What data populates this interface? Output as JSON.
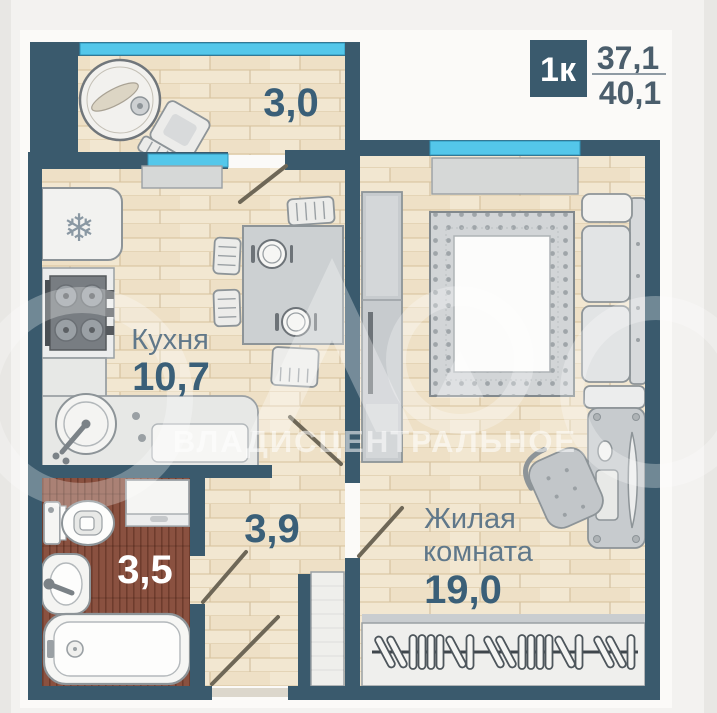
{
  "badge": {
    "rooms": "1к",
    "area_top": "37,1",
    "area_bottom": "40,1"
  },
  "rooms": {
    "balcony": {
      "area": "3,0"
    },
    "kitchen": {
      "name": "Кухня",
      "area": "10,7"
    },
    "bathroom": {
      "area": "3,5"
    },
    "hallway": {
      "area": "3,9"
    },
    "living_room": {
      "name_line1": "Жилая",
      "name_line2": "комната",
      "area": "19,0"
    }
  },
  "watermark": {
    "text": "ВЛАДИСЦЕНТРАЛЬНОЕ"
  },
  "icons": {
    "snowflake": "❄"
  },
  "colors": {
    "wall": "#3a5a6d",
    "window_glazing": "#54c7ea",
    "wood_floor": "#f2e7d1",
    "bathroom_floor": "#8a5140",
    "area_number_text": "#3a5f78",
    "room_name_text": "#60788a",
    "badge_background": "#3a5a6d"
  }
}
